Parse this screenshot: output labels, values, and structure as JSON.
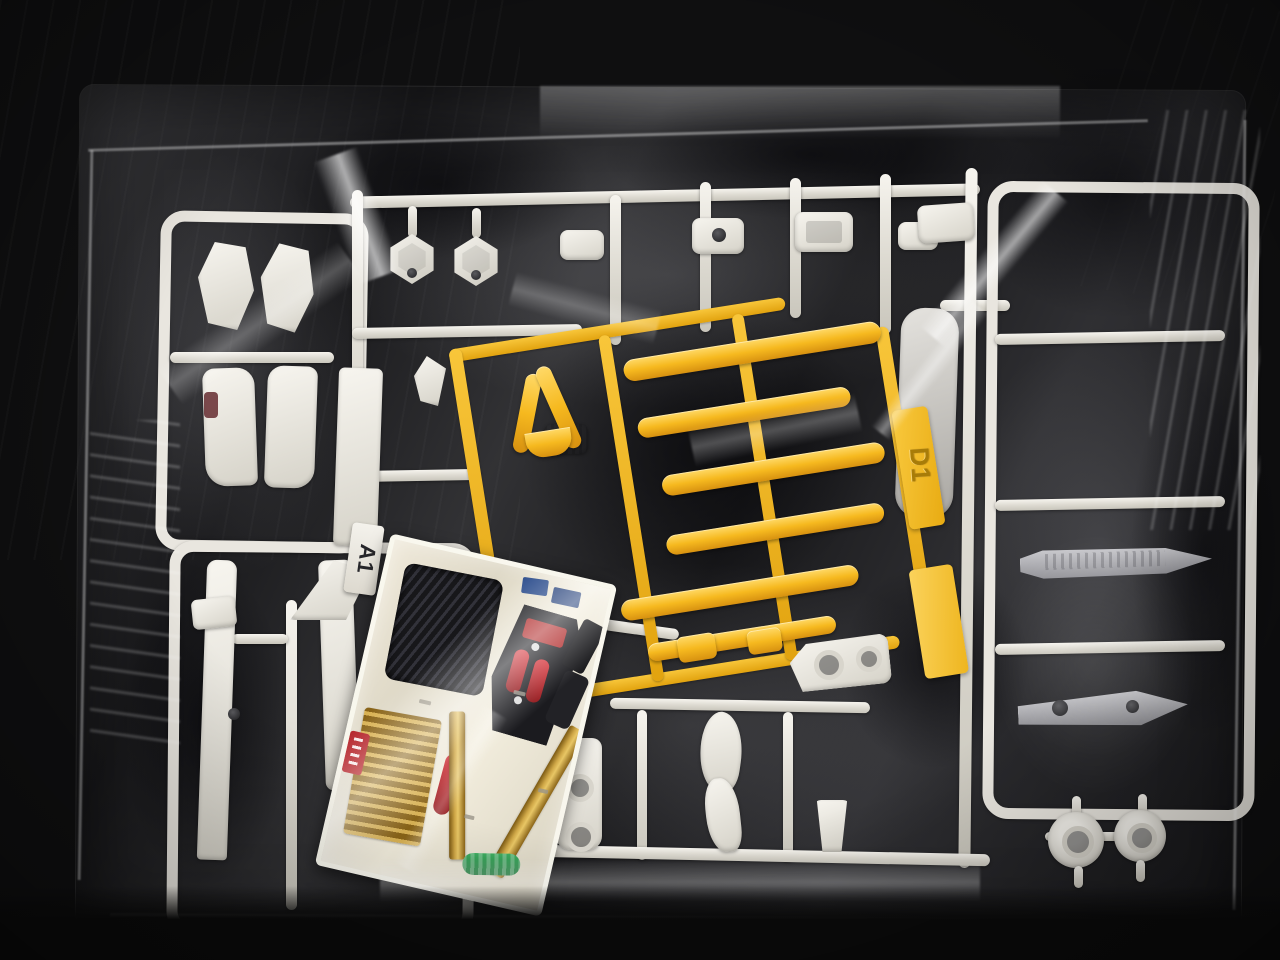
{
  "scene": {
    "subject": "Plastic model kit runners sealed in a clear bag with a decal sheet"
  },
  "tags": {
    "yellow_runner_label": "D1",
    "white_runner_label": "A1"
  },
  "colors": {
    "background": "#0f0f10",
    "white_plastic": "#e9e6df",
    "yellow_plastic": "#f6b91f",
    "sheet_cream": "#e9e3d3",
    "decal_gold": "#cfa747",
    "decal_red": "#b5242a",
    "decal_green": "#3fae62",
    "decal_blue": "#2e4f8e",
    "decal_black": "#1b1b1f"
  }
}
